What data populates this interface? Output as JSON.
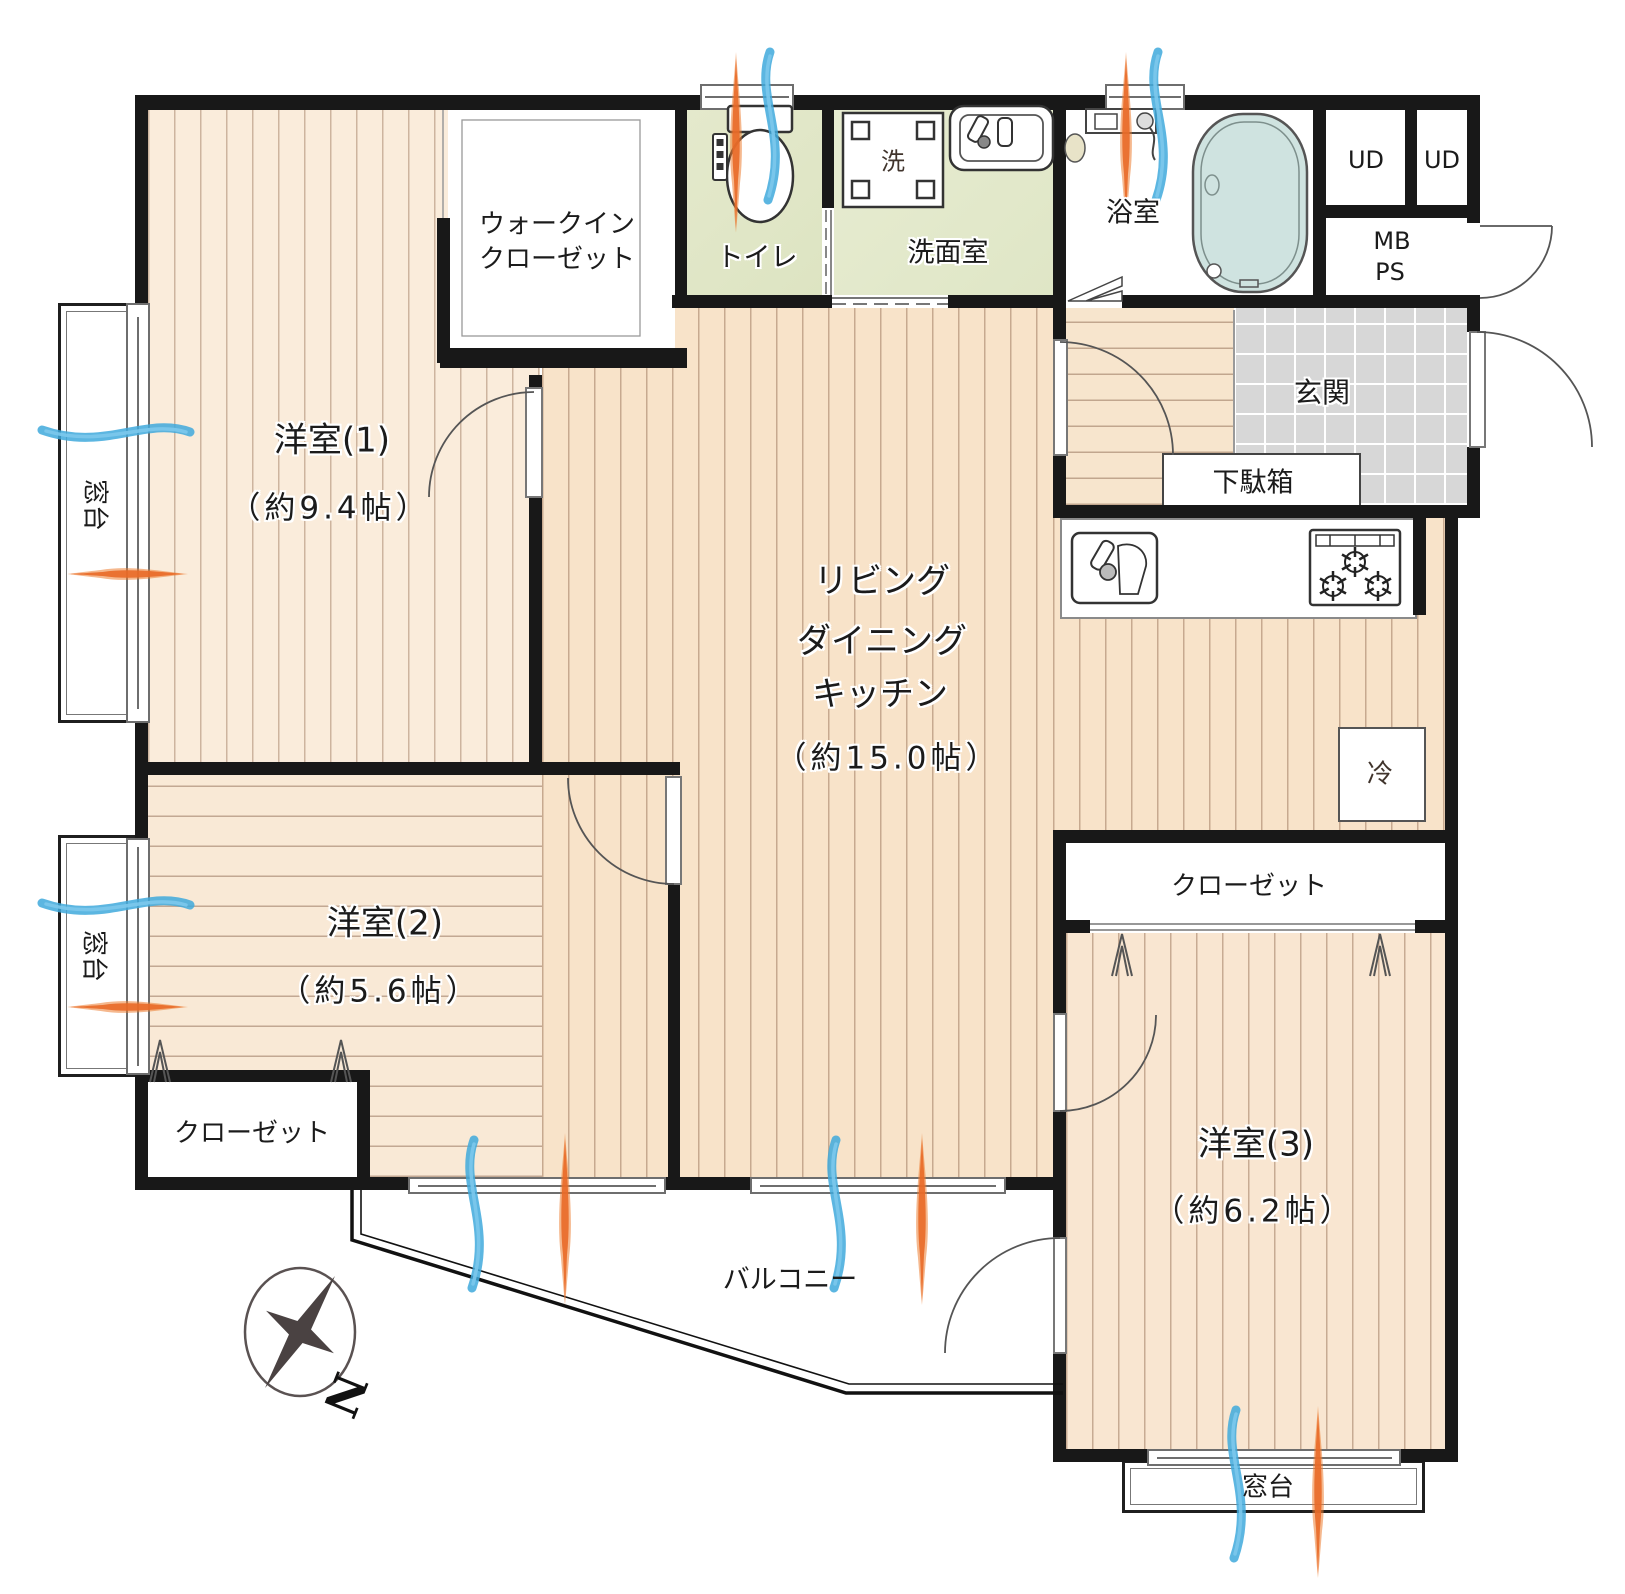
{
  "rooms": {
    "room1": {
      "name": "洋室(1)",
      "size": "（約9.4帖）"
    },
    "room2": {
      "name": "洋室(2)",
      "size": "（約5.6帖）"
    },
    "room3": {
      "name": "洋室(3)",
      "size": "（約6.2帖）"
    },
    "ldk": {
      "line1": "リビング",
      "line2": "ダイニング",
      "line3": "キッチン",
      "size": "（約15.0帖）"
    },
    "walkin": {
      "line1": "ウォークイン",
      "line2": "クローゼット"
    },
    "toilet": "トイレ",
    "washroom": "洗面室",
    "washer": "洗",
    "bath": "浴室",
    "ud1": "UD",
    "ud2": "UD",
    "mb": "MB",
    "ps": "PS",
    "genkan": "玄関",
    "shoebox": "下駄箱",
    "closet_right": "クローゼット",
    "closet_left": "クローゼット",
    "fridge": "冷",
    "balcony": "バルコニー",
    "sill_left1": "窓台",
    "sill_left2": "窓台",
    "sill_bottom": "窓台",
    "compass_n": "N"
  },
  "colors": {
    "wall": "#181818",
    "wood_light": "#faecdb",
    "wood_ldk": "#f8e3c9",
    "wet_green": "#dde4c2",
    "tile_grey": "#d7d7d7",
    "tub_teal": "#cfe3e0",
    "vent_blue": "#3fa9dc",
    "vent_orange": "#ed7d31"
  }
}
